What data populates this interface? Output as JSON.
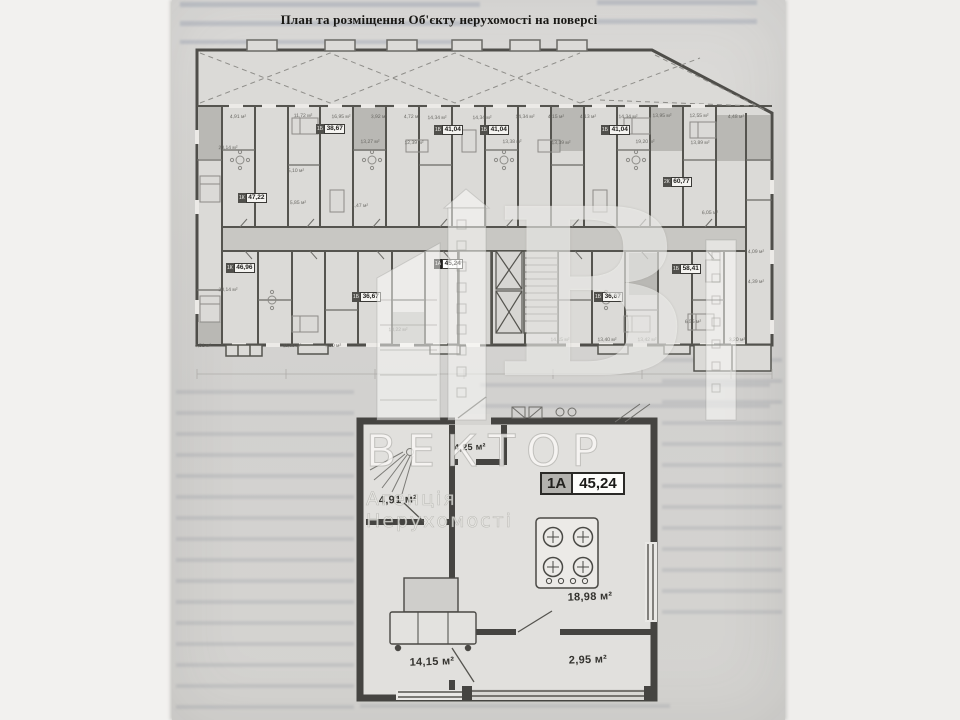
{
  "page": {
    "title": "План та розміщення Об'єкту нерухомості на поверсі"
  },
  "building_plan": {
    "unit_badges": [
      {
        "code": "1К",
        "area": "47,22",
        "x": 238,
        "y": 193
      },
      {
        "code": "1Б",
        "area": "38,67",
        "x": 316,
        "y": 124
      },
      {
        "code": "1Б",
        "area": "41,04",
        "x": 434,
        "y": 125
      },
      {
        "code": "1Б",
        "area": "41,04",
        "x": 480,
        "y": 125
      },
      {
        "code": "1Б",
        "area": "41,04",
        "x": 601,
        "y": 125
      },
      {
        "code": "2К",
        "area": "60,77",
        "x": 663,
        "y": 177
      },
      {
        "code": "1К",
        "area": "46,96",
        "x": 226,
        "y": 263
      },
      {
        "code": "1А",
        "area": "45,24",
        "x": 434,
        "y": 259,
        "highlight": true
      },
      {
        "code": "1Б",
        "area": "36,67",
        "x": 352,
        "y": 292
      },
      {
        "code": "1Б",
        "area": "36,67",
        "x": 594,
        "y": 292
      },
      {
        "code": "1Б",
        "area": "58,41",
        "x": 672,
        "y": 264
      }
    ],
    "room_areas": [
      {
        "x": 238,
        "y": 117,
        "label": "4,91 м²"
      },
      {
        "x": 303,
        "y": 116,
        "label": "11,72 м²"
      },
      {
        "x": 341,
        "y": 117,
        "label": "16,95 м²"
      },
      {
        "x": 379,
        "y": 117,
        "label": "3,92 м²"
      },
      {
        "x": 412,
        "y": 117,
        "label": "4,72 м²"
      },
      {
        "x": 437,
        "y": 118,
        "label": "14,34 м²"
      },
      {
        "x": 482,
        "y": 118,
        "label": "14,34 м²"
      },
      {
        "x": 525,
        "y": 117,
        "label": "14,34 м²"
      },
      {
        "x": 556,
        "y": 117,
        "label": "4,15 м²"
      },
      {
        "x": 588,
        "y": 117,
        "label": "4,13 м²"
      },
      {
        "x": 628,
        "y": 117,
        "label": "14,34 м²"
      },
      {
        "x": 662,
        "y": 116,
        "label": "13,95 м²"
      },
      {
        "x": 699,
        "y": 116,
        "label": "12,55 м²"
      },
      {
        "x": 736,
        "y": 117,
        "label": "4,48 м²"
      },
      {
        "x": 370,
        "y": 142,
        "label": "13,27 м²"
      },
      {
        "x": 414,
        "y": 143,
        "label": "12,39 м²"
      },
      {
        "x": 512,
        "y": 142,
        "label": "13,38 м²"
      },
      {
        "x": 561,
        "y": 143,
        "label": "13,39 м²"
      },
      {
        "x": 645,
        "y": 142,
        "label": "19,20 м²"
      },
      {
        "x": 700,
        "y": 143,
        "label": "13,89 м²"
      },
      {
        "x": 228,
        "y": 148,
        "label": "20,14 м²"
      },
      {
        "x": 296,
        "y": 171,
        "label": "5,10 м²"
      },
      {
        "x": 298,
        "y": 203,
        "label": "5,85 м²"
      },
      {
        "x": 360,
        "y": 206,
        "label": "4,47 м²"
      },
      {
        "x": 710,
        "y": 213,
        "label": "6,05 м²"
      },
      {
        "x": 756,
        "y": 252,
        "label": "4,09 м²"
      },
      {
        "x": 756,
        "y": 282,
        "label": "4,39 м²"
      },
      {
        "x": 228,
        "y": 290,
        "label": "20,14 м²"
      },
      {
        "x": 203,
        "y": 346,
        "label": "4,51 м²"
      },
      {
        "x": 292,
        "y": 346,
        "label": "11,39 м²"
      },
      {
        "x": 333,
        "y": 346,
        "label": "7,90 м²"
      },
      {
        "x": 398,
        "y": 330,
        "label": "13,22 м²"
      },
      {
        "x": 560,
        "y": 340,
        "label": "14,15 м²"
      },
      {
        "x": 607,
        "y": 340,
        "label": "13,40 м²"
      },
      {
        "x": 647,
        "y": 340,
        "label": "13,42 м²"
      },
      {
        "x": 693,
        "y": 322,
        "label": "6,55 м²"
      },
      {
        "x": 737,
        "y": 340,
        "label": "3,20 м²"
      }
    ]
  },
  "apartment_plan": {
    "badge": {
      "code": "1А",
      "area": "45,24"
    },
    "room_labels": [
      {
        "room": "wc",
        "label": "4,25 м²",
        "x": 470,
        "y": 447,
        "small": true
      },
      {
        "room": "hall",
        "label": "4,91 м²",
        "x": 398,
        "y": 500
      },
      {
        "room": "kitchen-living",
        "label": "18,98 м²",
        "x": 590,
        "y": 597
      },
      {
        "room": "bedroom",
        "label": "14,15 м²",
        "x": 432,
        "y": 662
      },
      {
        "room": "balcony",
        "label": "2,95 м²",
        "x": 588,
        "y": 660
      }
    ]
  },
  "watermark": {
    "letter": "В",
    "name": "ВЕКТОР",
    "subtitle": "Агенція Нерухомості"
  }
}
